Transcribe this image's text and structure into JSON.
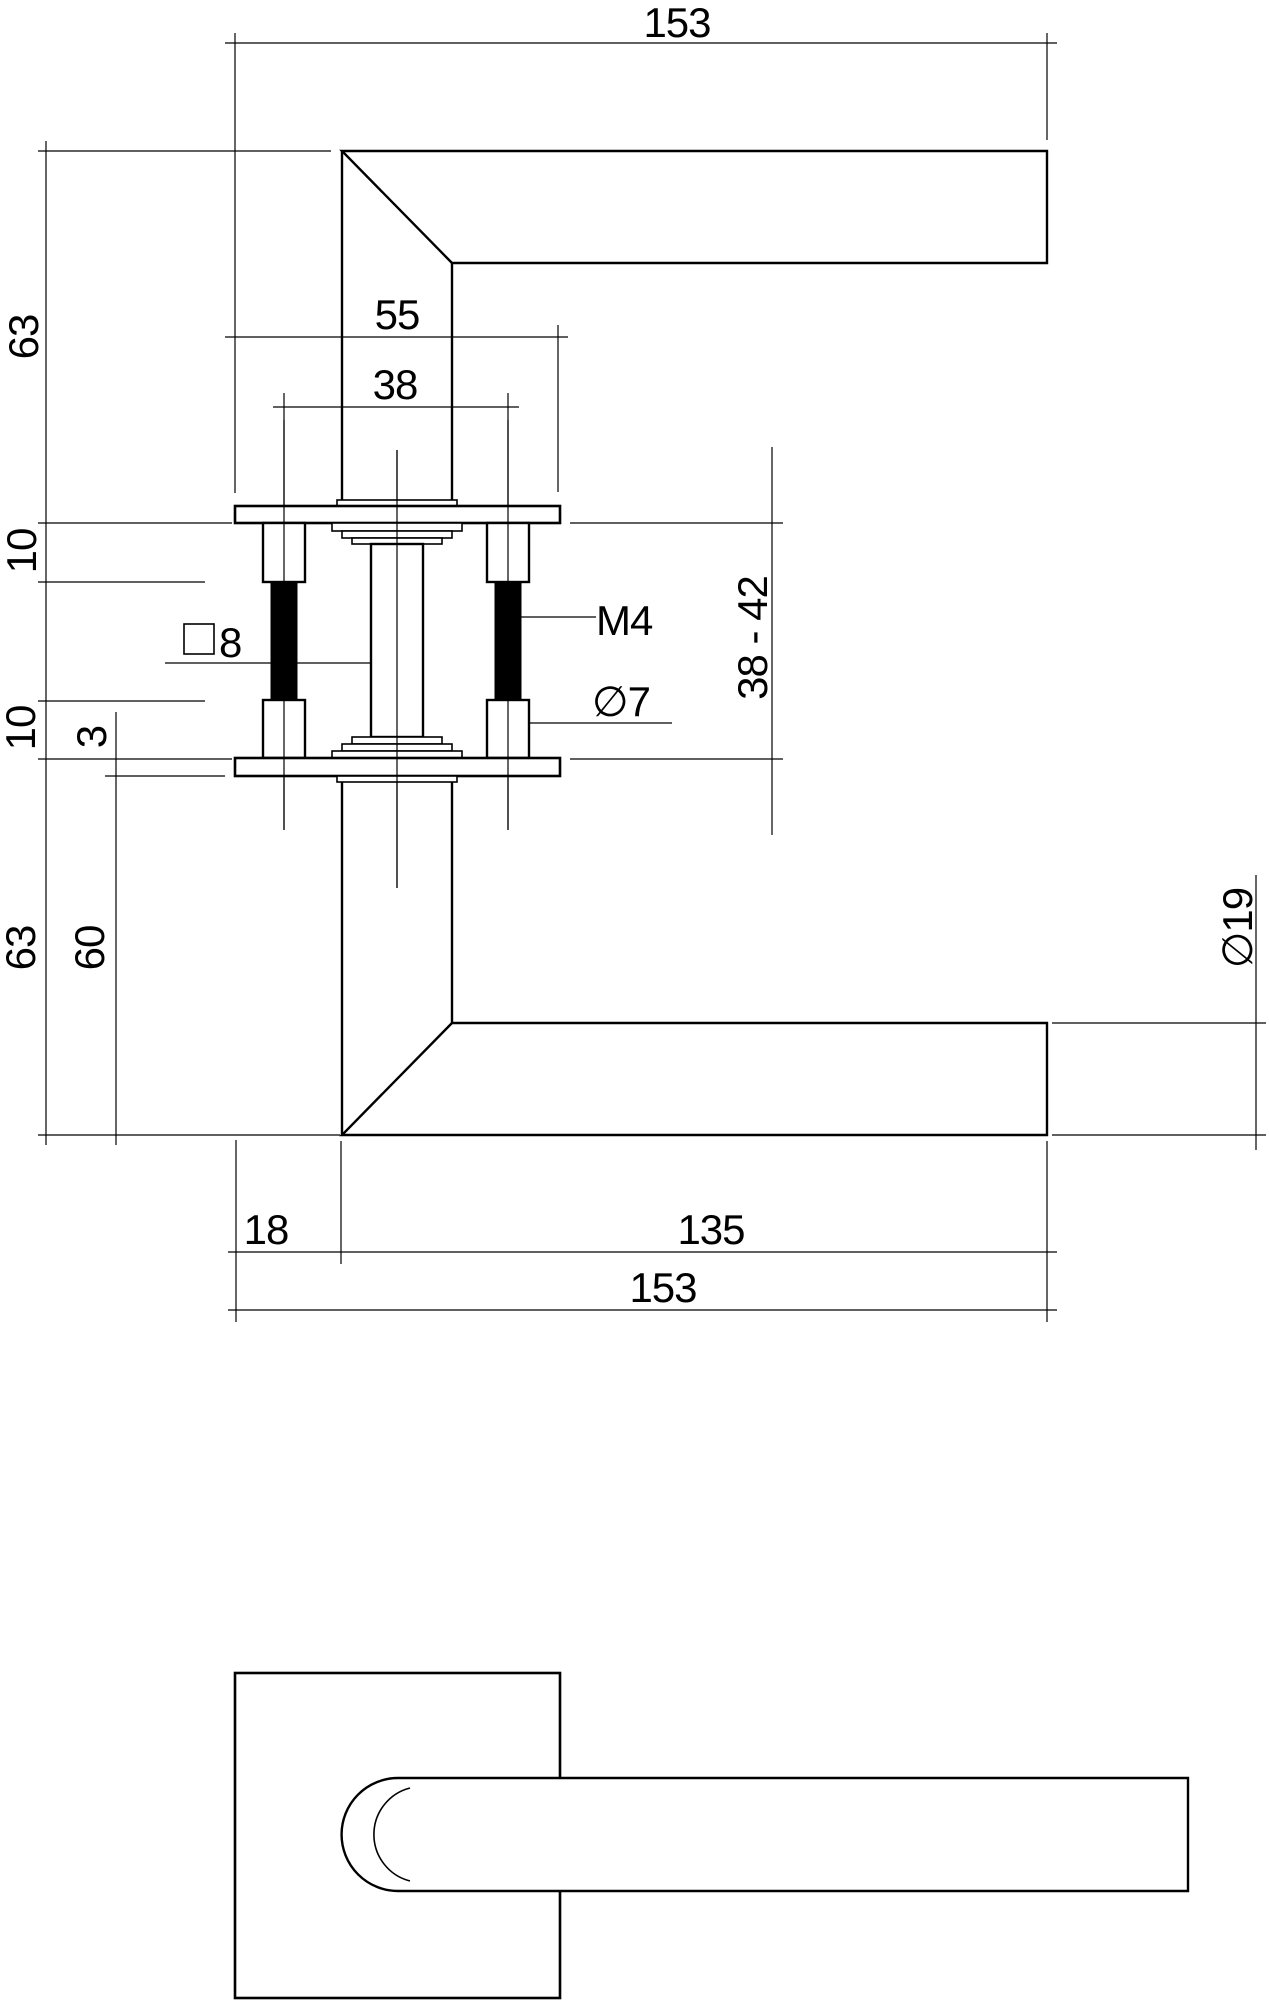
{
  "dims": {
    "top_total": "153",
    "rose_width": "55",
    "hole_spacing": "38",
    "upper_height": "63",
    "upper_bush": "10",
    "lower_bush": "10",
    "rose_thickness": "3",
    "lower_height": "63",
    "lower_height_inner": "60",
    "spindle_size": "8",
    "thread_size": "M4",
    "screw_hole_dia": "∅7",
    "door_thickness_range": "38 - 42",
    "grip_dia": "∅19",
    "neck_offset": "18",
    "lever_length": "135",
    "bottom_total": "153"
  },
  "colors": {
    "line": "#000000",
    "background": "#ffffff"
  }
}
